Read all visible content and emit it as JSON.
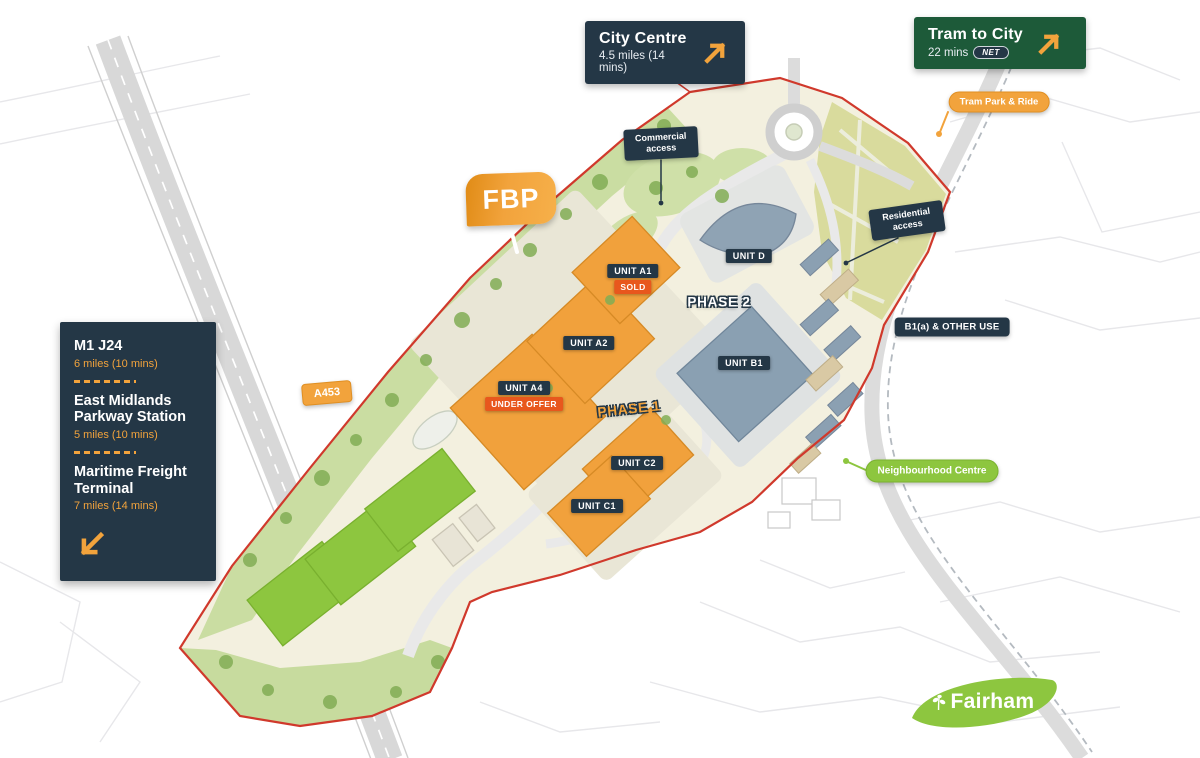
{
  "colors": {
    "navy": "#243746",
    "orange": "#F2A33C",
    "orange_deep": "#E8571D",
    "green_dark": "#1D5A39",
    "lime": "#8DC63F",
    "boundary_red": "#D0392C"
  },
  "callouts": {
    "city_centre": {
      "title": "City Centre",
      "subtitle": "4.5 miles (14 mins)"
    },
    "tram_to_city": {
      "title": "Tram to City",
      "subtitle": "22 mins",
      "net_logo": "NET"
    },
    "tram_park_ride": "Tram Park & Ride",
    "commercial_access": "Commercial access",
    "residential_access": "Residential access",
    "b1a_other_use": "B1(a) & OTHER USE",
    "neighbourhood_centre": "Neighbourhood Centre",
    "road_a453": "A453"
  },
  "logos": {
    "fbp": "FBP",
    "fairham": "Fairham"
  },
  "distance_panel": {
    "items": [
      {
        "title": "M1 J24",
        "subtitle": "6 miles (10 mins)"
      },
      {
        "title": "East Midlands Parkway Station",
        "subtitle": "5 miles (10 mins)"
      },
      {
        "title": "Maritime Freight Terminal",
        "subtitle": "7 miles (14 mins)"
      }
    ]
  },
  "units": {
    "a1": {
      "label": "UNIT A1",
      "status": "SOLD"
    },
    "a2": {
      "label": "UNIT A2"
    },
    "a4": {
      "label": "UNIT A4",
      "status": "UNDER OFFER"
    },
    "c1": {
      "label": "UNIT C1"
    },
    "c2": {
      "label": "UNIT C2"
    },
    "b1": {
      "label": "UNIT B1"
    },
    "d": {
      "label": "UNIT D"
    }
  },
  "phases": {
    "phase1": "PHASE 1",
    "phase2": "PHASE 2"
  }
}
